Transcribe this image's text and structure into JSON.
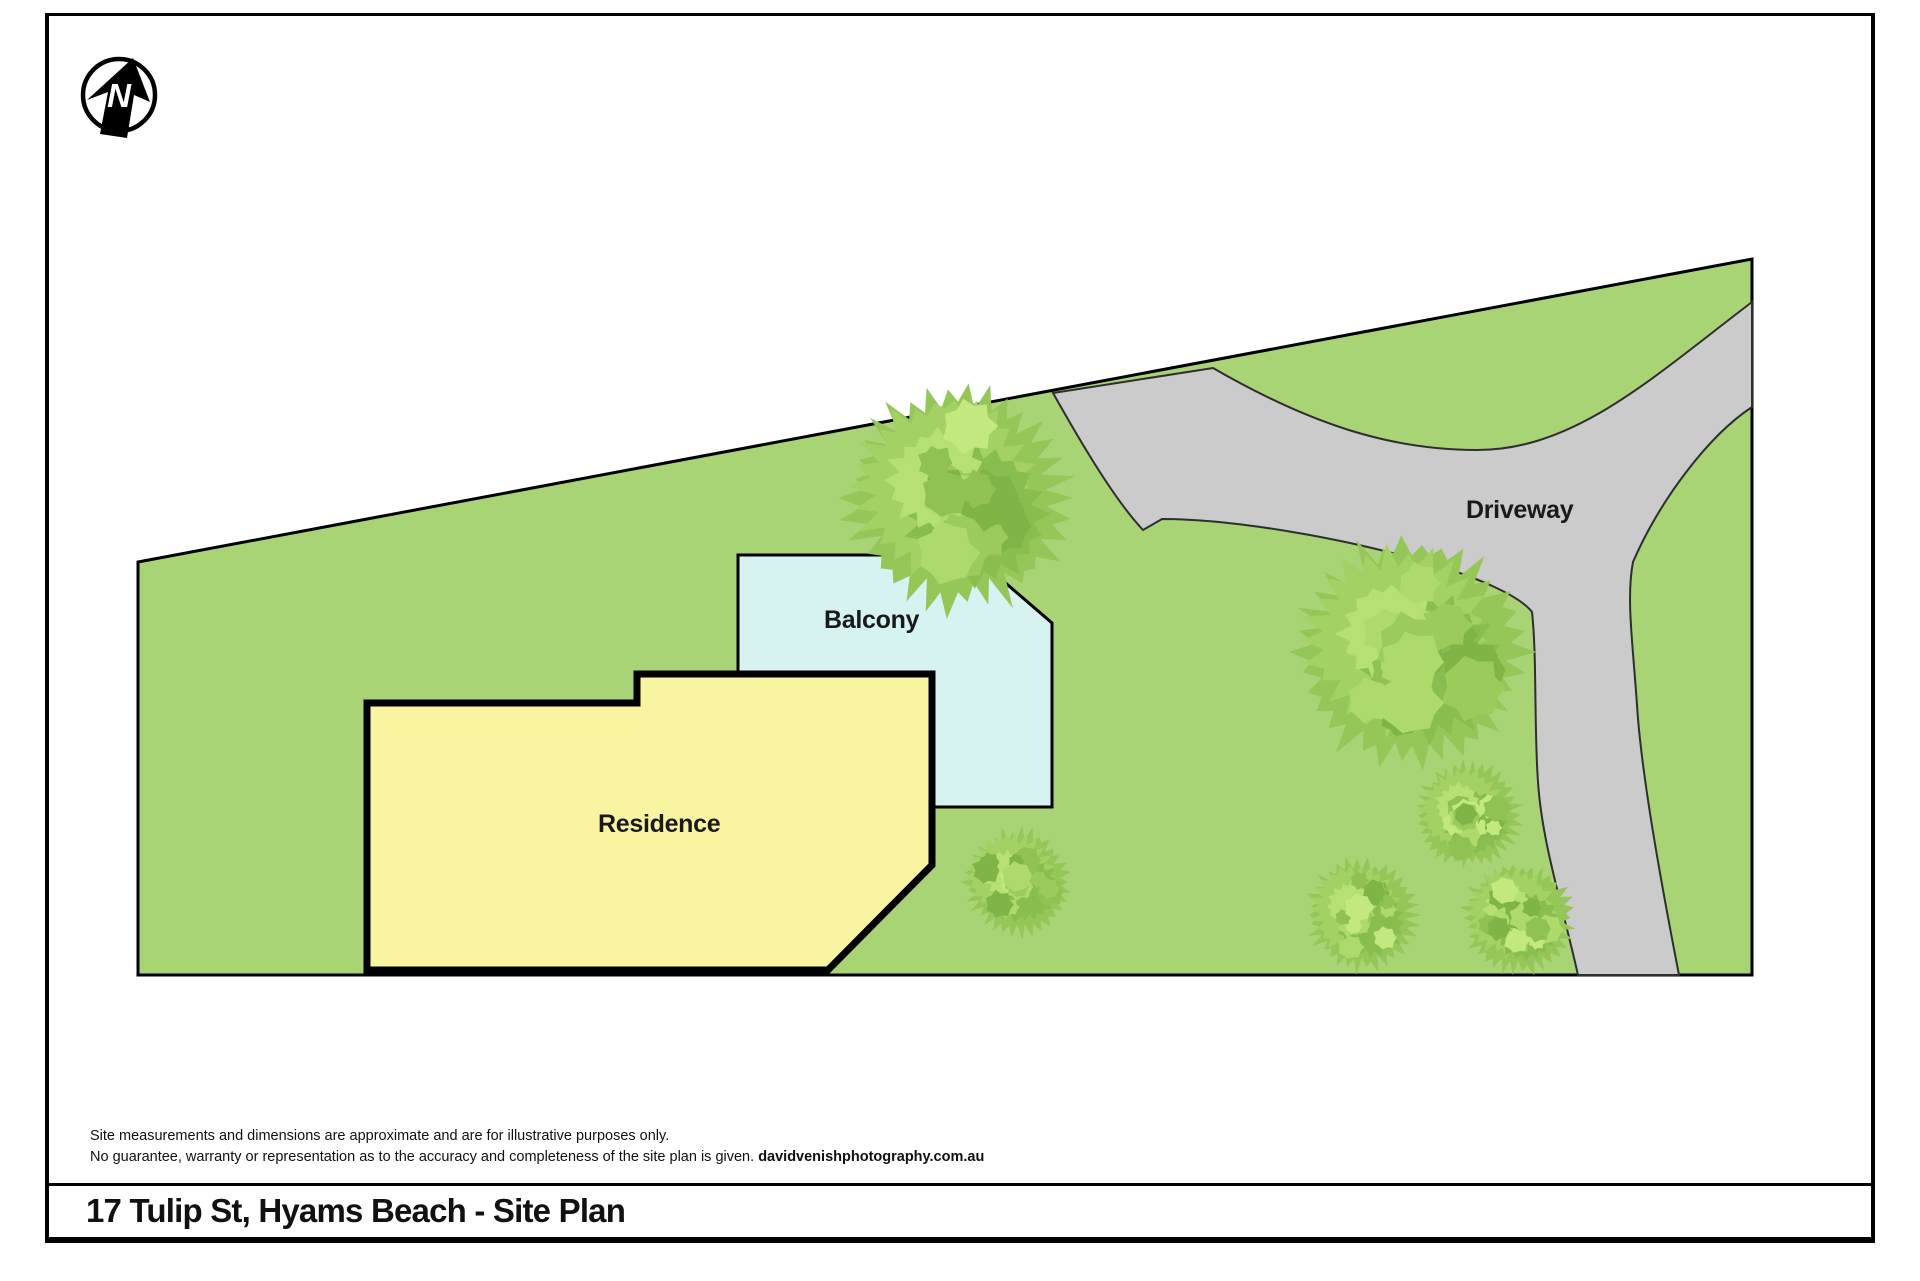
{
  "footer": {
    "title": "17 Tulip St, Hyams Beach - Site Plan"
  },
  "disclaimer": {
    "line1": "Site measurements and dimensions are approximate and are for illustrative purposes only.",
    "line2_normal": "No guarantee, warranty or representation as to the accuracy and completeness of the site plan is given. ",
    "line2_bold": "davidvenishphotography.com.au"
  },
  "north_badge": {
    "letter": "N"
  },
  "plan": {
    "labels": {
      "residence": "Residence",
      "balcony": "Balcony",
      "driveway": "Driveway"
    },
    "colors": {
      "site_fill": "#a9d476",
      "site_stroke": "#000000",
      "driveway_fill": "#cbcbcb",
      "driveway_stroke": "#2e2e2e",
      "balcony_fill": "#d6f2f1",
      "balcony_stroke": "#000000",
      "residence_fill": "#f8f4a2",
      "residence_stroke": "#000000",
      "tree_base": "#95c658",
      "tree_mid": "#a4d164",
      "tree_dark": "#88bd4f",
      "tree_light": "#b7e073",
      "tree_patches": [
        "#7fb447",
        "#8fc252",
        "#aeda6b",
        "#c3e87f",
        "#9bcb5b"
      ]
    },
    "geometry": {
      "site_path": "M138,562 L1752,259 L1752,975 L138,975 Z",
      "driveway_path": "M1053,393 L1213,368 C1310,424 1390,450 1477,450 C1575,450 1652,378 1752,302 L1752,407 C1708,436 1660,500 1633,562 C1626,598 1633,645 1637,705 C1641,770 1659,872 1679,975 L1578,975 C1561,900 1542,842 1538,782 C1534,726 1537,658 1532,612 C1520,596 1478,578 1438,566 C1348,538 1232,519 1162,519 L1143,530 C1112,497 1075,432 1053,393 Z",
      "balcony_path": "M738,555 L973,555 L1052,623 L1052,807 L738,807 Z",
      "residence_path": "M367,703 L637,703 L637,674 L932,674 L932,865 L828,970 L367,970 Z",
      "trees": [
        {
          "x": 958,
          "y": 498,
          "r": 112
        },
        {
          "x": 1412,
          "y": 652,
          "r": 115
        },
        {
          "x": 1017,
          "y": 882,
          "r": 53
        },
        {
          "x": 1468,
          "y": 815,
          "r": 52
        },
        {
          "x": 1362,
          "y": 915,
          "r": 55
        },
        {
          "x": 1518,
          "y": 918,
          "r": 55
        }
      ],
      "north": {
        "cx": 119,
        "cy": 95,
        "r": 36,
        "arrow_points": "133,58 150,102 134,95 127,138 100,134 108,92 87,100"
      }
    }
  }
}
